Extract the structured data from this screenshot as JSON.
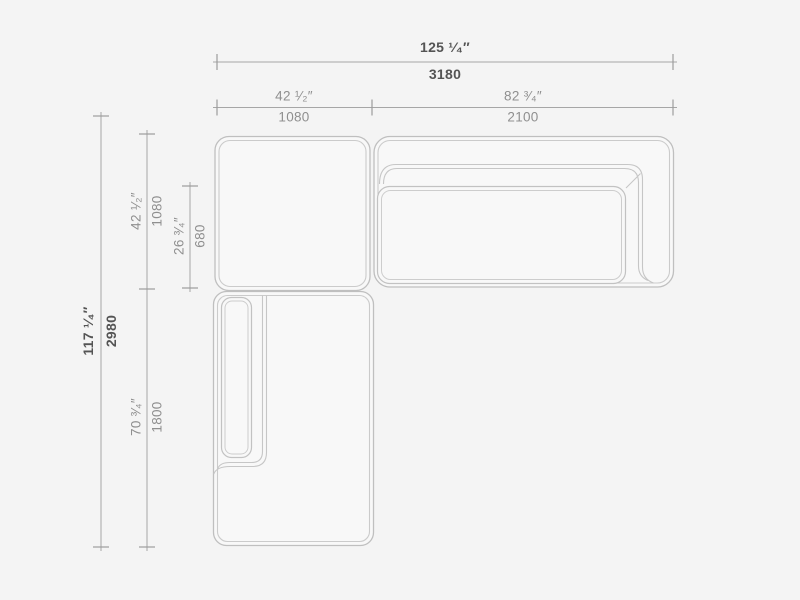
{
  "diagram": {
    "type": "sectional-sofa-top-view-dimension-drawing",
    "units": [
      "inches",
      "mm"
    ],
    "dimensions": {
      "width_total": {
        "inches": "125 ¹⁄₄″",
        "mm": "3180"
      },
      "width_left_module": {
        "inches": "42 ¹⁄₂″",
        "mm": "1080"
      },
      "width_right_module": {
        "inches": "82 ³⁄₄″",
        "mm": "2100"
      },
      "height_total": {
        "inches": "117 ¹⁄₄″",
        "mm": "2980"
      },
      "height_top_module": {
        "inches": "42 ¹⁄₂″",
        "mm": "1080"
      },
      "height_seat_depth": {
        "inches": "26 ³⁄₄″",
        "mm": "680"
      },
      "height_chaise": {
        "inches": "70 ³⁄₄″",
        "mm": "1800"
      }
    },
    "colors": {
      "background": "#f4f4f4",
      "module_fill": "#f8f8f8",
      "outline": "#c2c2c2",
      "dimension_line": "#a6a6a6",
      "text_primary": "#545454",
      "text_secondary": "#8f8f8f"
    }
  }
}
